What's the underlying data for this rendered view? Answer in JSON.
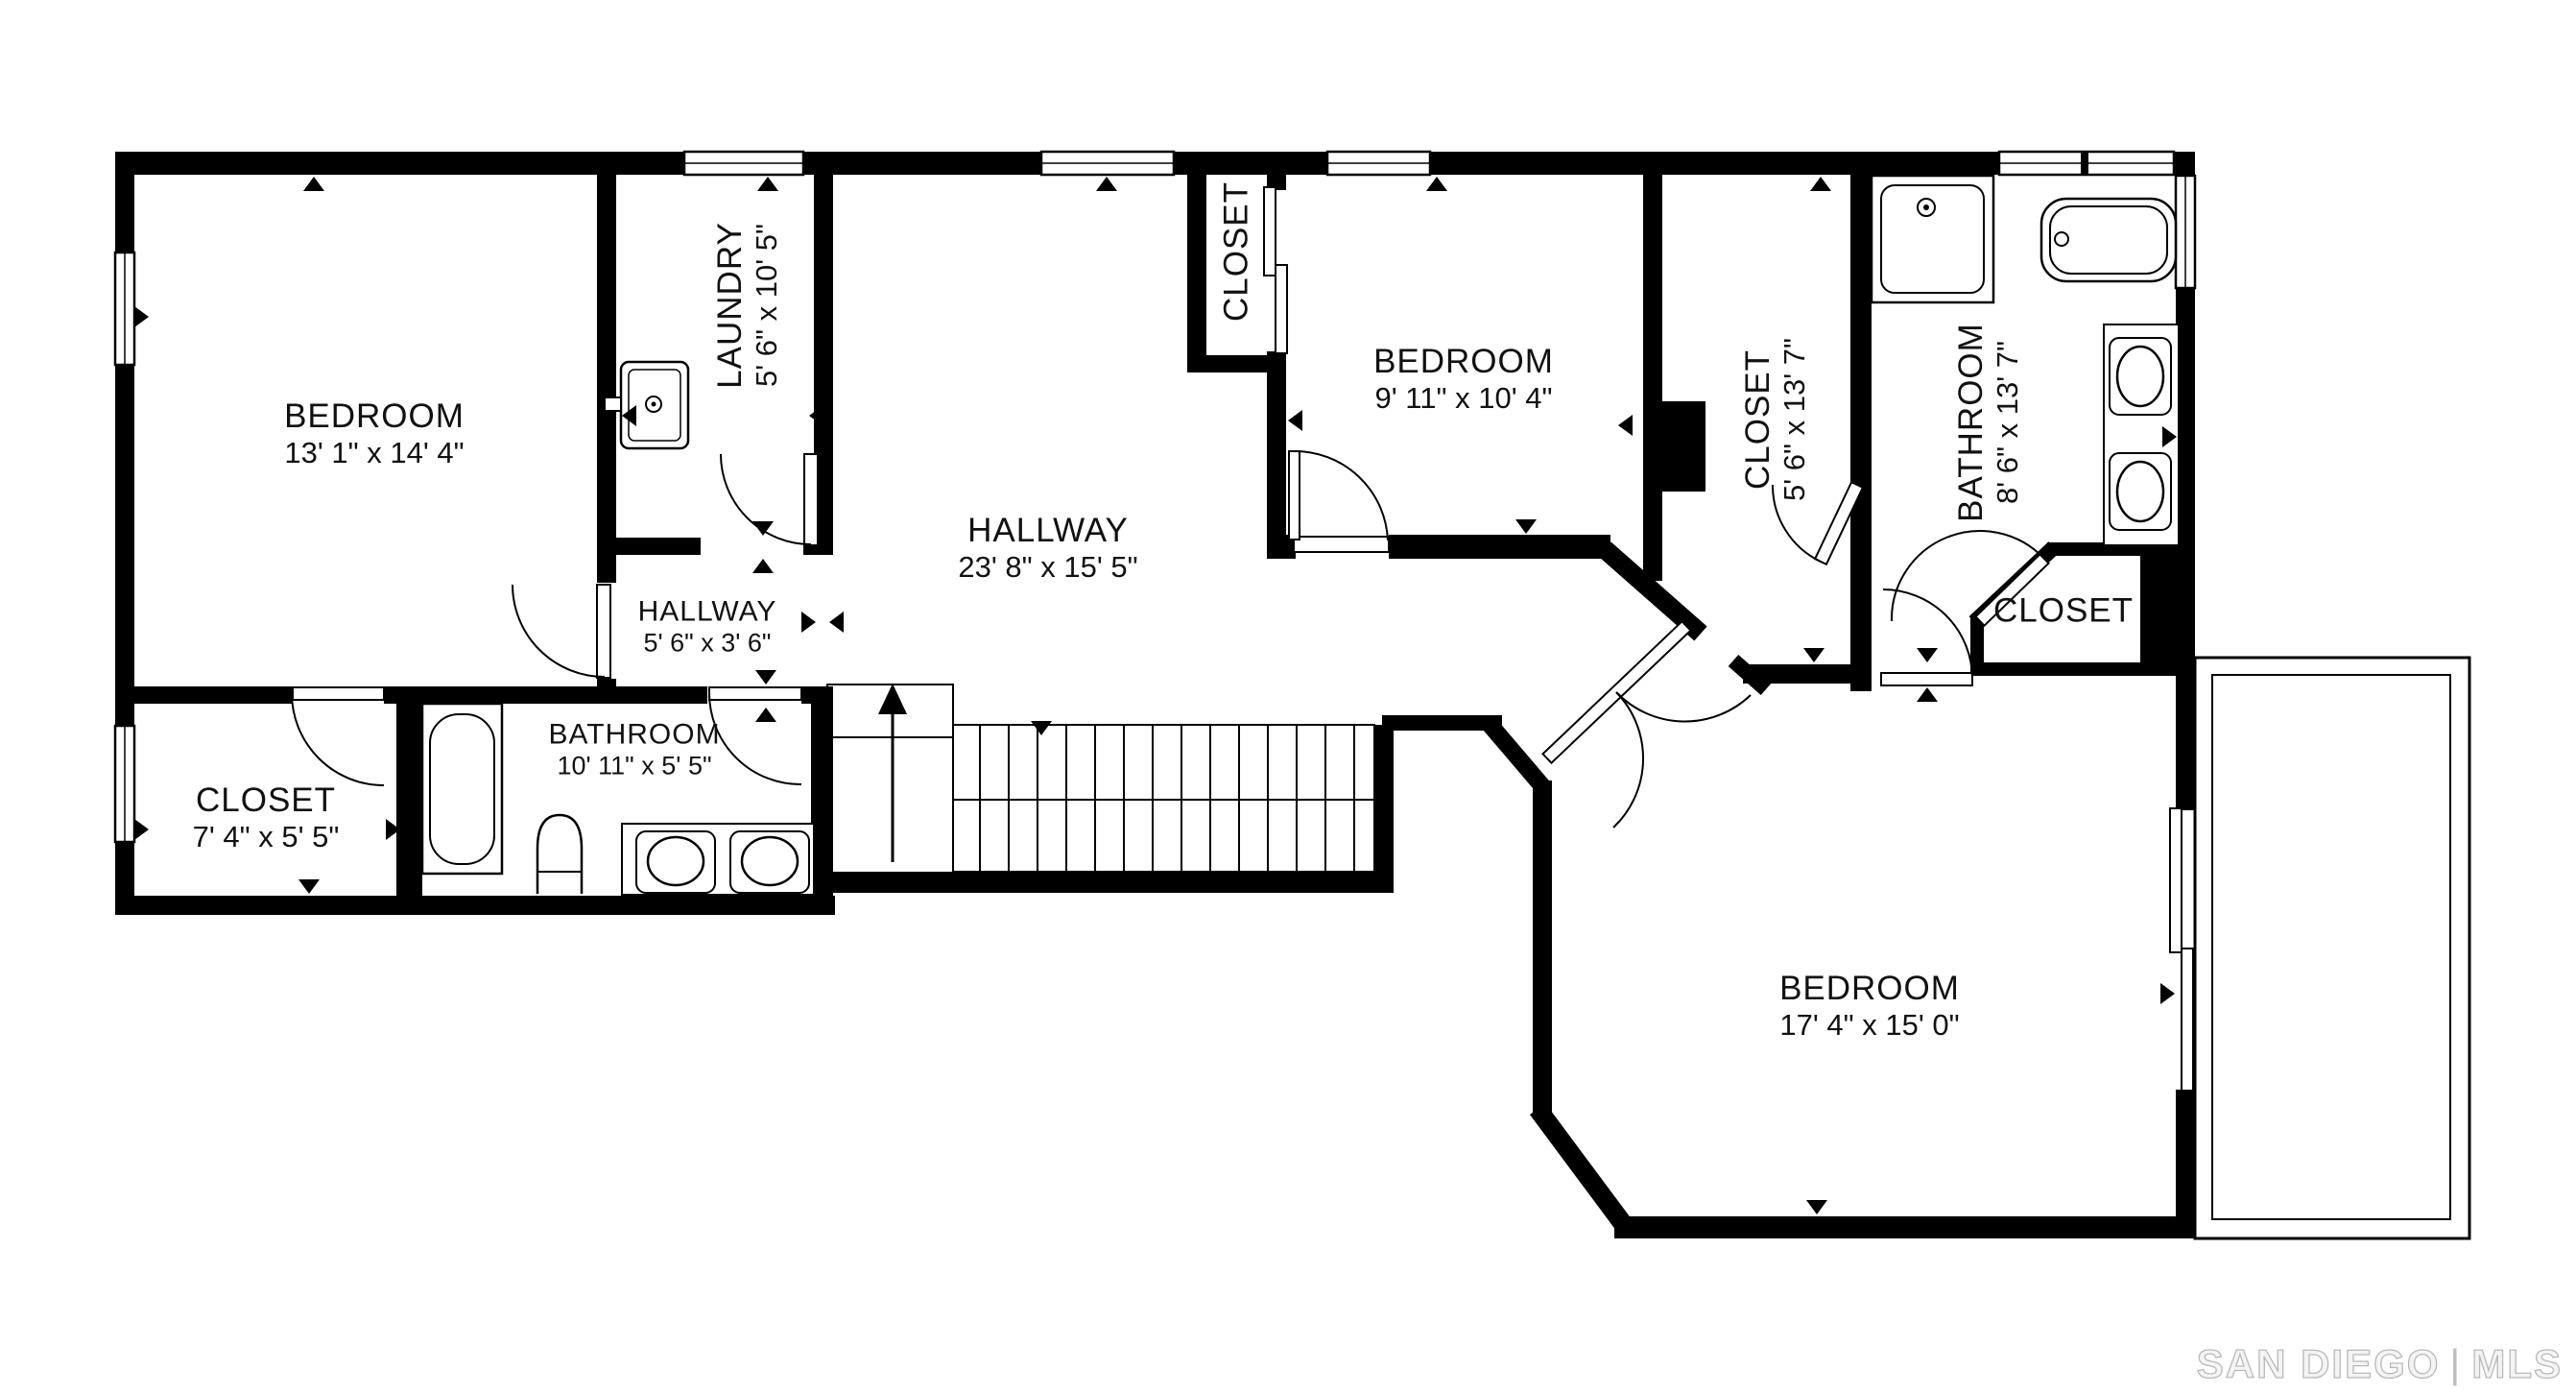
{
  "background": "#ffffff",
  "wall_color": "#000000",
  "rooms": [
    {
      "id": "bedroom-1",
      "name": "BEDROOM",
      "dims": "13' 1\" x 14' 4\"",
      "orientation": "horizontal"
    },
    {
      "id": "laundry",
      "name": "LAUNDRY",
      "dims": "5' 6\" x 10' 5\"",
      "orientation": "vertical"
    },
    {
      "id": "closet-top",
      "name": "CLOSET",
      "dims": "",
      "orientation": "vertical"
    },
    {
      "id": "bedroom-2",
      "name": "BEDROOM",
      "dims": "9' 11\" x 10' 4\"",
      "orientation": "horizontal"
    },
    {
      "id": "closet-master",
      "name": "CLOSET",
      "dims": "5' 6\" x 13' 7\"",
      "orientation": "vertical"
    },
    {
      "id": "bathroom-master",
      "name": "BATHROOM",
      "dims": "8' 6\" x 13' 7\"",
      "orientation": "vertical"
    },
    {
      "id": "closet-walkin",
      "name": "CLOSET",
      "dims": "",
      "orientation": "horizontal"
    },
    {
      "id": "hallway-main",
      "name": "HALLWAY",
      "dims": "23' 8\" x 15' 5\"",
      "orientation": "horizontal"
    },
    {
      "id": "hallway-small",
      "name": "HALLWAY",
      "dims": "5' 6\" x 3' 6\"",
      "orientation": "horizontal"
    },
    {
      "id": "bathroom-hall",
      "name": "BATHROOM",
      "dims": "10' 11\" x 5' 5\"",
      "orientation": "horizontal"
    },
    {
      "id": "closet-bottom-left",
      "name": "CLOSET",
      "dims": "7' 4\" x 5' 5\"",
      "orientation": "horizontal"
    },
    {
      "id": "bedroom-3",
      "name": "BEDROOM",
      "dims": "17' 4\" x 15' 0\"",
      "orientation": "horizontal"
    }
  ],
  "fixtures": [
    "laundry-sink",
    "hall-bathtub",
    "hall-toilet",
    "hall-double-vanity",
    "shower",
    "master-bathtub",
    "master-double-vanity",
    "staircase-up",
    "balcony",
    "sliding-doors"
  ],
  "watermark": {
    "text_left": "SAN DIEGO",
    "separator": "|",
    "text_right": "MLS",
    "color": "#bdbdbd"
  }
}
